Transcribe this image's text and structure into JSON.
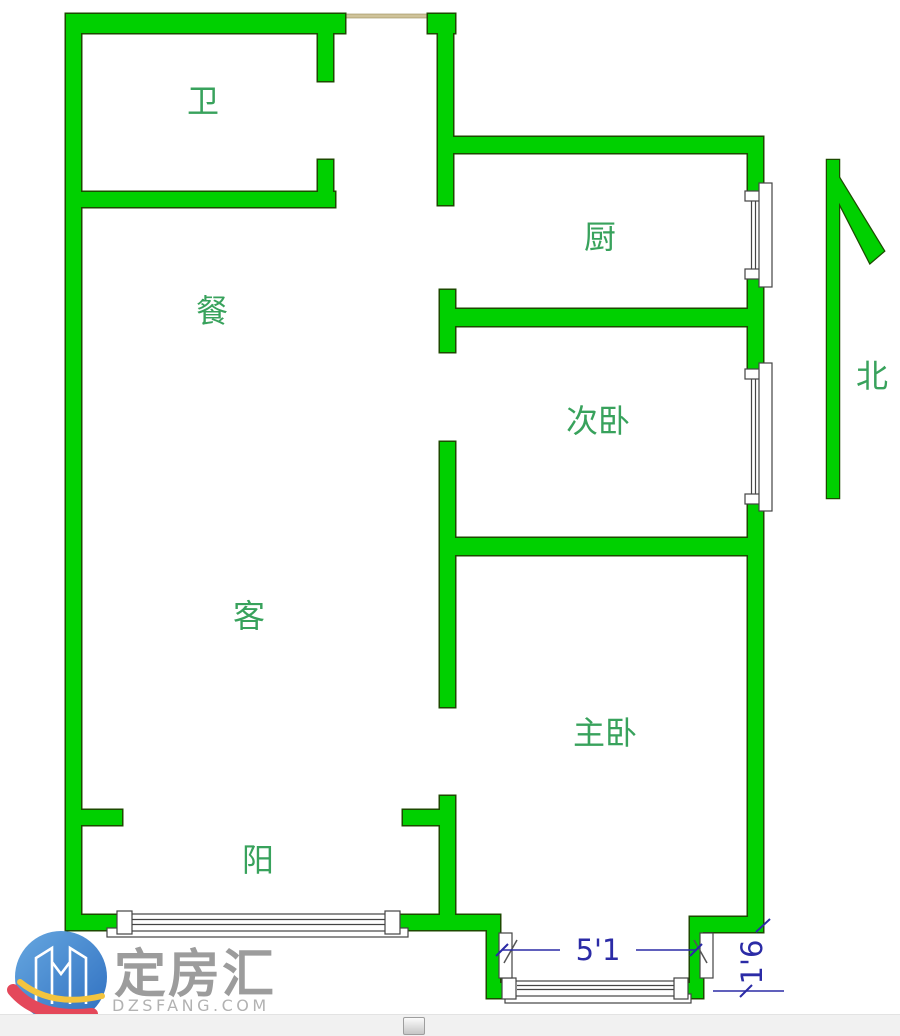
{
  "window": {
    "width": 900,
    "height": 1036
  },
  "floor_plan": {
    "rooms": [
      {
        "id": "bathroom",
        "label": "卫"
      },
      {
        "id": "dining",
        "label": "餐"
      },
      {
        "id": "kitchen",
        "label": "厨"
      },
      {
        "id": "second-bedroom",
        "label": "次卧"
      },
      {
        "id": "living-room",
        "label": "客"
      },
      {
        "id": "master-bedroom",
        "label": "主卧"
      },
      {
        "id": "balcony",
        "label": "阳"
      }
    ],
    "compass": {
      "label": "北"
    },
    "dimensions": [
      {
        "id": "bay-window-width",
        "label": "5'1"
      },
      {
        "id": "bay-window-depth",
        "label": "1'6"
      }
    ],
    "colors": {
      "wall_fill": "#00d000",
      "wall_outline": "#1c4a00",
      "room_label": "#38a25c",
      "dimension_text": "#2b2ba6",
      "entry_door": "#cfc39a",
      "window_outline": "#444444"
    }
  },
  "watermark": {
    "brand": "定房汇",
    "site": "DZSFANG.COM",
    "brand_color": "#9c9c9c",
    "site_color": "#b2b2b2"
  },
  "scrollbar": {
    "orientation": "horizontal"
  }
}
